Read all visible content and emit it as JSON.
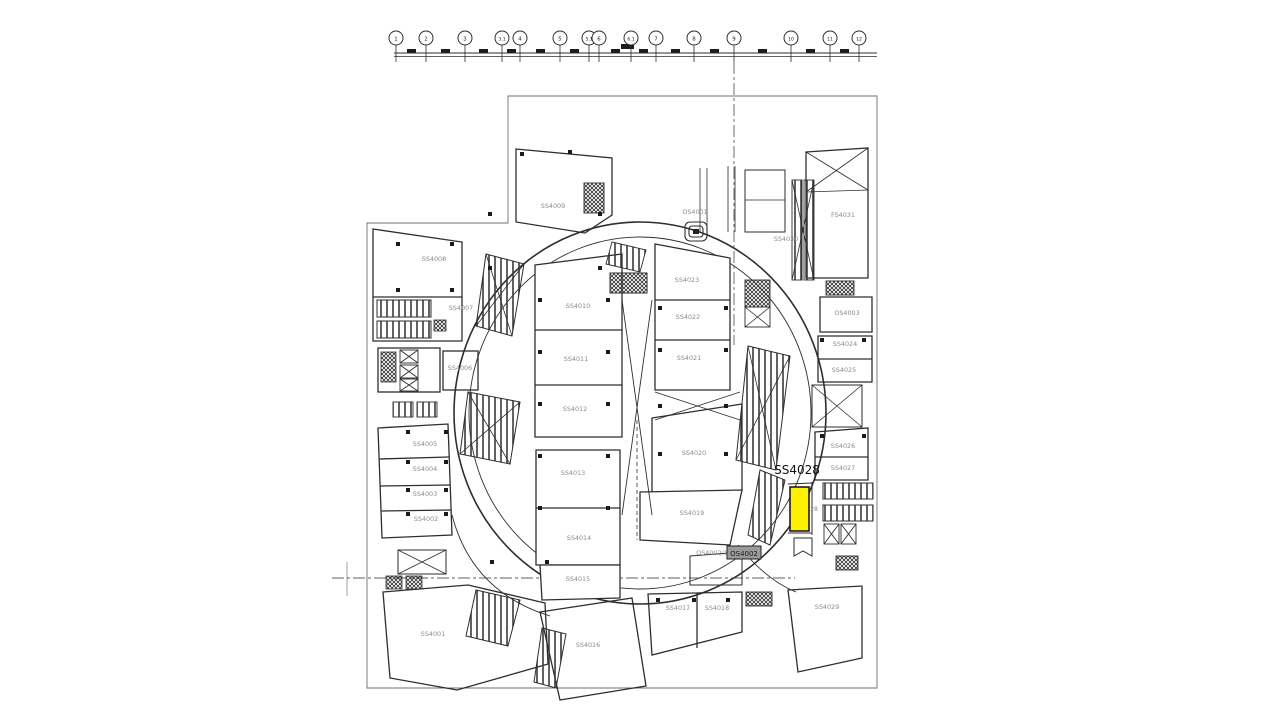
{
  "plan": {
    "highlight": {
      "label": "SS4028",
      "x": 797,
      "y": 474,
      "color": "#FDF000"
    },
    "boxed_label": {
      "text": "OS4002"
    },
    "partial_label": {
      "text": "28"
    },
    "colors": {
      "wall": "#2e2e2e",
      "boundary": "#6f6f6f",
      "room_label": "#8a8a8a",
      "highlight_fill": "#FDF000",
      "highlight_label": "#111111",
      "centerline": "#5f5f5f"
    },
    "rooms": [
      {
        "label": "SS4001",
        "x": 433,
        "y": 636
      },
      {
        "label": "SS4002",
        "x": 426,
        "y": 521
      },
      {
        "label": "SS4003",
        "x": 425,
        "y": 496
      },
      {
        "label": "SS4004",
        "x": 425,
        "y": 471
      },
      {
        "label": "SS4005",
        "x": 425,
        "y": 446
      },
      {
        "label": "SS4006",
        "x": 460,
        "y": 370
      },
      {
        "label": "SS4007",
        "x": 461,
        "y": 310
      },
      {
        "label": "SS4008",
        "x": 434,
        "y": 261
      },
      {
        "label": "SS4009",
        "x": 553,
        "y": 208
      },
      {
        "label": "SS4010",
        "x": 578,
        "y": 308
      },
      {
        "label": "SS4011",
        "x": 576,
        "y": 361
      },
      {
        "label": "SS4012",
        "x": 575,
        "y": 411
      },
      {
        "label": "SS4013",
        "x": 573,
        "y": 475
      },
      {
        "label": "SS4014",
        "x": 579,
        "y": 540
      },
      {
        "label": "SS4015",
        "x": 578,
        "y": 581
      },
      {
        "label": "SS4016",
        "x": 588,
        "y": 647
      },
      {
        "label": "SS4017",
        "x": 678,
        "y": 610
      },
      {
        "label": "SS4018",
        "x": 717,
        "y": 610
      },
      {
        "label": "SS4019",
        "x": 692,
        "y": 515
      },
      {
        "label": "SS4020",
        "x": 694,
        "y": 455
      },
      {
        "label": "SS4021",
        "x": 689,
        "y": 360
      },
      {
        "label": "SS4022",
        "x": 688,
        "y": 319
      },
      {
        "label": "SS4023",
        "x": 687,
        "y": 282
      },
      {
        "label": "SS4024",
        "x": 845,
        "y": 346
      },
      {
        "label": "SS4025",
        "x": 844,
        "y": 372
      },
      {
        "label": "SS4026",
        "x": 843,
        "y": 448
      },
      {
        "label": "SS4027",
        "x": 843,
        "y": 470
      },
      {
        "label": "SS4029",
        "x": 827,
        "y": 609
      },
      {
        "label": "SS4030",
        "x": 786,
        "y": 241
      },
      {
        "label": "FS4031",
        "x": 843,
        "y": 217
      },
      {
        "label": "OS4001",
        "x": 695,
        "y": 214
      },
      {
        "label": "OS4003",
        "x": 847,
        "y": 315
      },
      {
        "label": "OS4002/1",
        "x": 712,
        "y": 555
      }
    ],
    "grid_bubbles": [
      {
        "label": "1",
        "x": 396
      },
      {
        "label": "2",
        "x": 426
      },
      {
        "label": "3",
        "x": 465
      },
      {
        "label": "3.1",
        "x": 502
      },
      {
        "label": "4",
        "x": 520
      },
      {
        "label": "5",
        "x": 560
      },
      {
        "label": "5.1",
        "x": 589
      },
      {
        "label": "6",
        "x": 599
      },
      {
        "label": "6.1",
        "x": 631
      },
      {
        "label": "7",
        "x": 656
      },
      {
        "label": "8",
        "x": 694
      },
      {
        "label": "9",
        "x": 734
      },
      {
        "label": "10",
        "x": 791
      },
      {
        "label": "11",
        "x": 830
      },
      {
        "label": "12",
        "x": 859
      }
    ]
  }
}
